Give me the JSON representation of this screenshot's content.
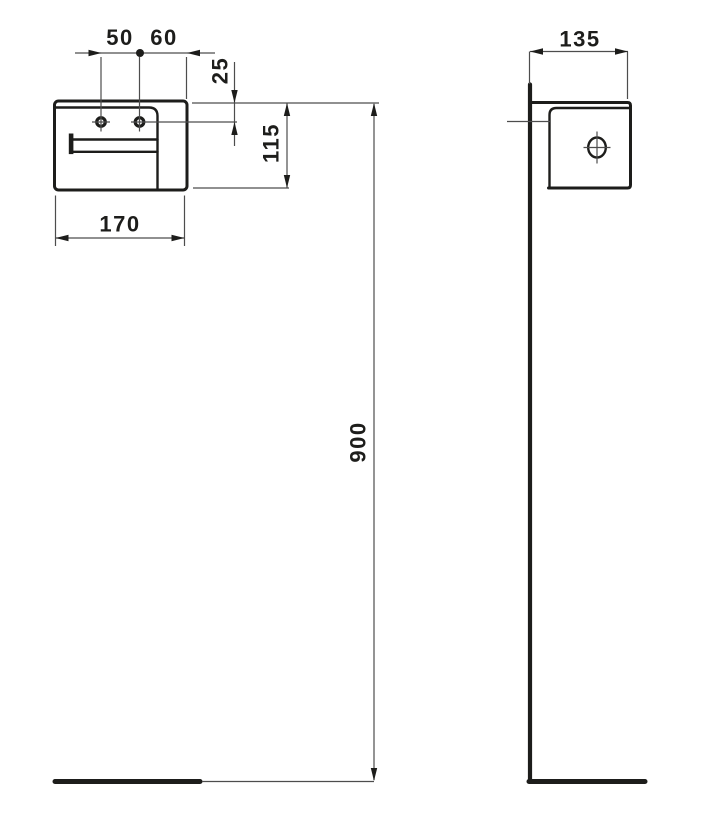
{
  "drawing": {
    "type": "technical-dimension-drawing",
    "subject": "wall-mounted paper roll holder, front and side elevation",
    "units": "mm",
    "colors": {
      "background": "#ffffff",
      "outline": "#1d1d1b",
      "dimension_line": "#4d4d4d",
      "text": "#1d1d1b"
    },
    "labels": {
      "hole_spacing": "50",
      "hole_to_edge": "60",
      "top_to_hole": "25",
      "body_height": "115",
      "body_width": "170",
      "body_depth": "135",
      "mounting_height": "900"
    }
  }
}
